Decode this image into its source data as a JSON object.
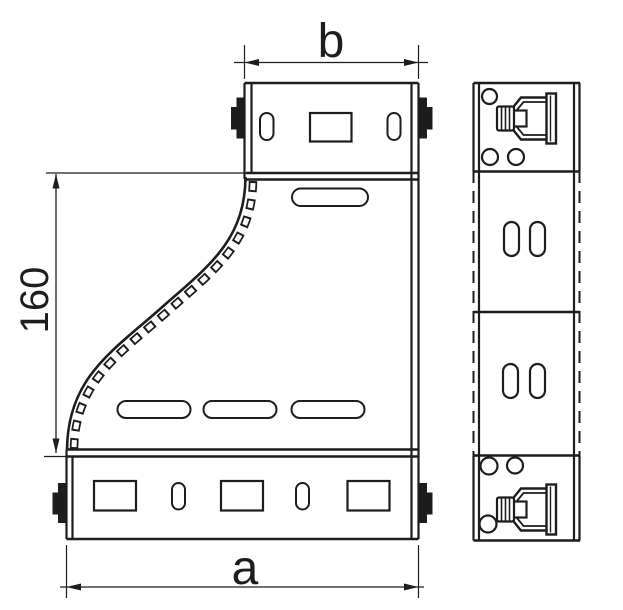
{
  "page": {
    "background": "#ffffff",
    "stroke_color": "#1d1d1b"
  },
  "drawing": {
    "kind": "technical-line-drawing",
    "subject": "cable-tray-riser-reducer",
    "views": [
      "front-view",
      "side-view"
    ],
    "dimensions": {
      "a": {
        "label": "a",
        "position": "bottom-width"
      },
      "b": {
        "label": "b",
        "position": "top-width"
      },
      "height": {
        "label": "160",
        "position": "left-vertical"
      }
    }
  }
}
